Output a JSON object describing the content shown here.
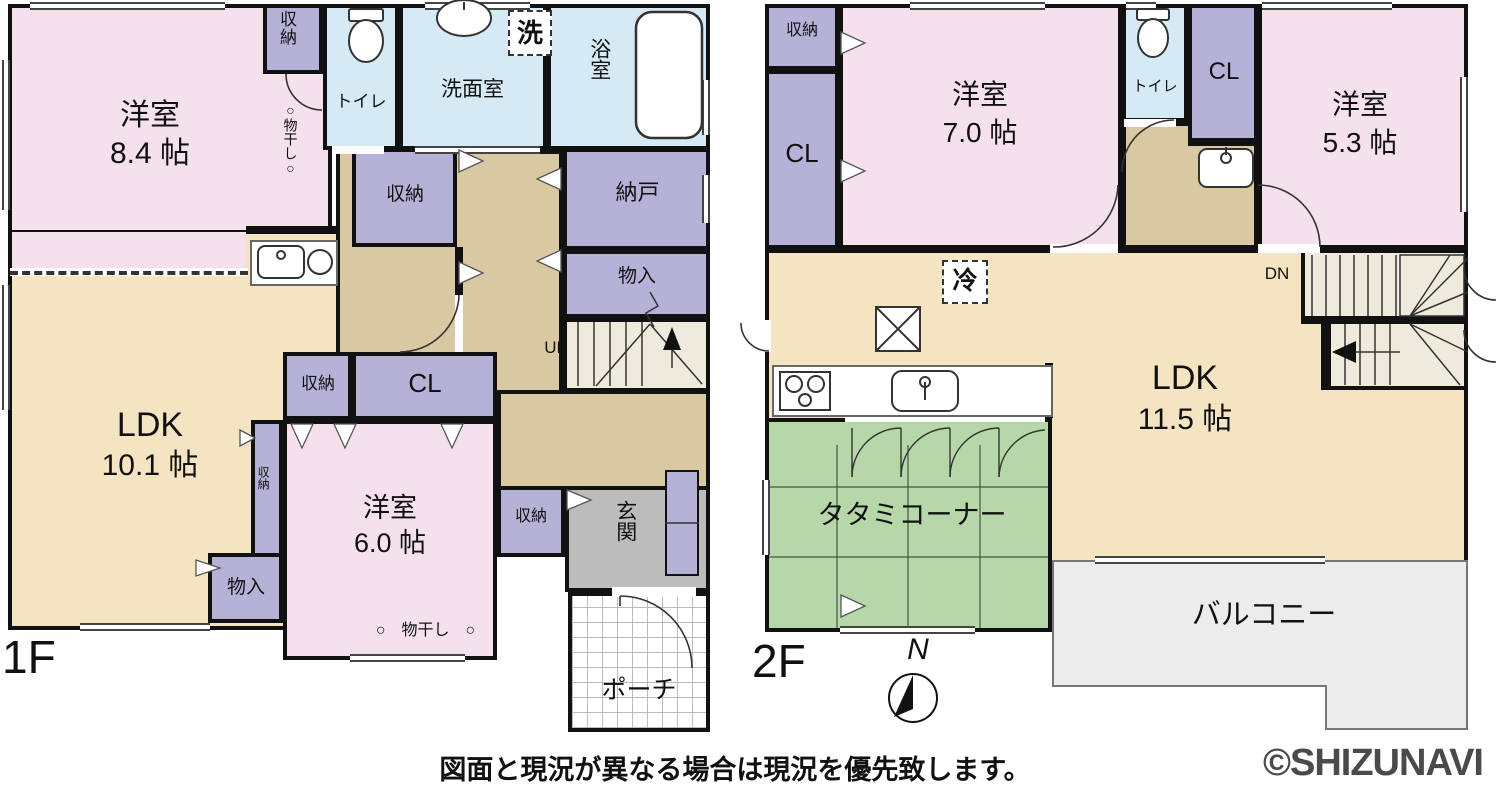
{
  "colors": {
    "wall": "#111111",
    "pink": "#f5e1ec",
    "purple": "#b6b1d7",
    "blue": "#d6eaf5",
    "beige": "#f5e4c2",
    "tan": "#d9c9a3",
    "green": "#b6d8a9",
    "gray": "#bcbcbc",
    "balcony": "#ececec",
    "stairs": "#efebdc",
    "watermark": "#4a4a4a"
  },
  "f1": {
    "floor_label": "1F",
    "room84_name": "洋室",
    "room84_size": "8.4 帖",
    "closet_top": "収納",
    "toilet": "トイレ",
    "monohoshi_v": "○物干し○",
    "washroom": "洗面室",
    "washer": "洗",
    "bath": "浴室",
    "nando": "納戸",
    "monoire_right": "物入",
    "closet_mid": "収納",
    "up": "UP",
    "ldk_name": "LDK",
    "ldk_size": "10.1 帖",
    "closet_block": "収納",
    "cl": "CL",
    "closet_thin": "収納",
    "room60_name": "洋室",
    "room60_size": "6.0 帖",
    "monohoshi_h": "○　物干し　○",
    "monoire_left": "物入",
    "closet_right": "収納",
    "genkan": "玄関",
    "porch": "ポーチ"
  },
  "f2": {
    "floor_label": "2F",
    "closet_top_left": "収納",
    "cl_left": "CL",
    "room70_name": "洋室",
    "room70_size": "7.0 帖",
    "toilet": "トイレ",
    "cl_right": "CL",
    "room53_name": "洋室",
    "room53_size": "5.3 帖",
    "fridge": "冷",
    "ldk_name": "LDK",
    "ldk_size": "11.5 帖",
    "dn": "DN",
    "tatami": "タタミコーナー",
    "balcony": "バルコニー",
    "north": "N"
  },
  "footer": {
    "disclaimer": "図面と現況が異なる場合は現況を優先致します。",
    "watermark": "©SHIZUNAVI"
  }
}
